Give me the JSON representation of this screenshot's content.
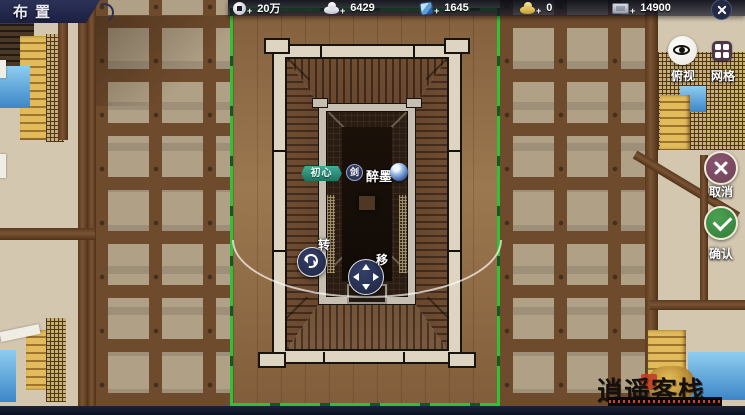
{
  "header": {
    "title": "布置",
    "plus": "+",
    "currencies": [
      {
        "icon": "copper-coin-icon",
        "value": "20万"
      },
      {
        "icon": "silver-ingot-icon",
        "value": "6429"
      },
      {
        "icon": "jade-token-icon",
        "value": "1645"
      },
      {
        "icon": "gold-ingot-icon",
        "value": "0"
      },
      {
        "icon": "banknote-icon",
        "value": "14900"
      }
    ]
  },
  "sidebar": {
    "overhead_view_label": "俯视",
    "grid_label": "网格",
    "cancel_label": "取消",
    "confirm_label": "确认"
  },
  "placement": {
    "guild_badge": "初心",
    "school": "剑",
    "player_name": "醉墨",
    "rotate_label": "转",
    "move_label": "移"
  },
  "watermark": {
    "title": "逍遥客栈"
  },
  "colors": {
    "selection_green": "#2ec235",
    "confirm_green": "#3f9a46",
    "cancel_plum": "#7d4b62",
    "badge_teal": "#2f9480",
    "banner_navy": "#272c52"
  }
}
